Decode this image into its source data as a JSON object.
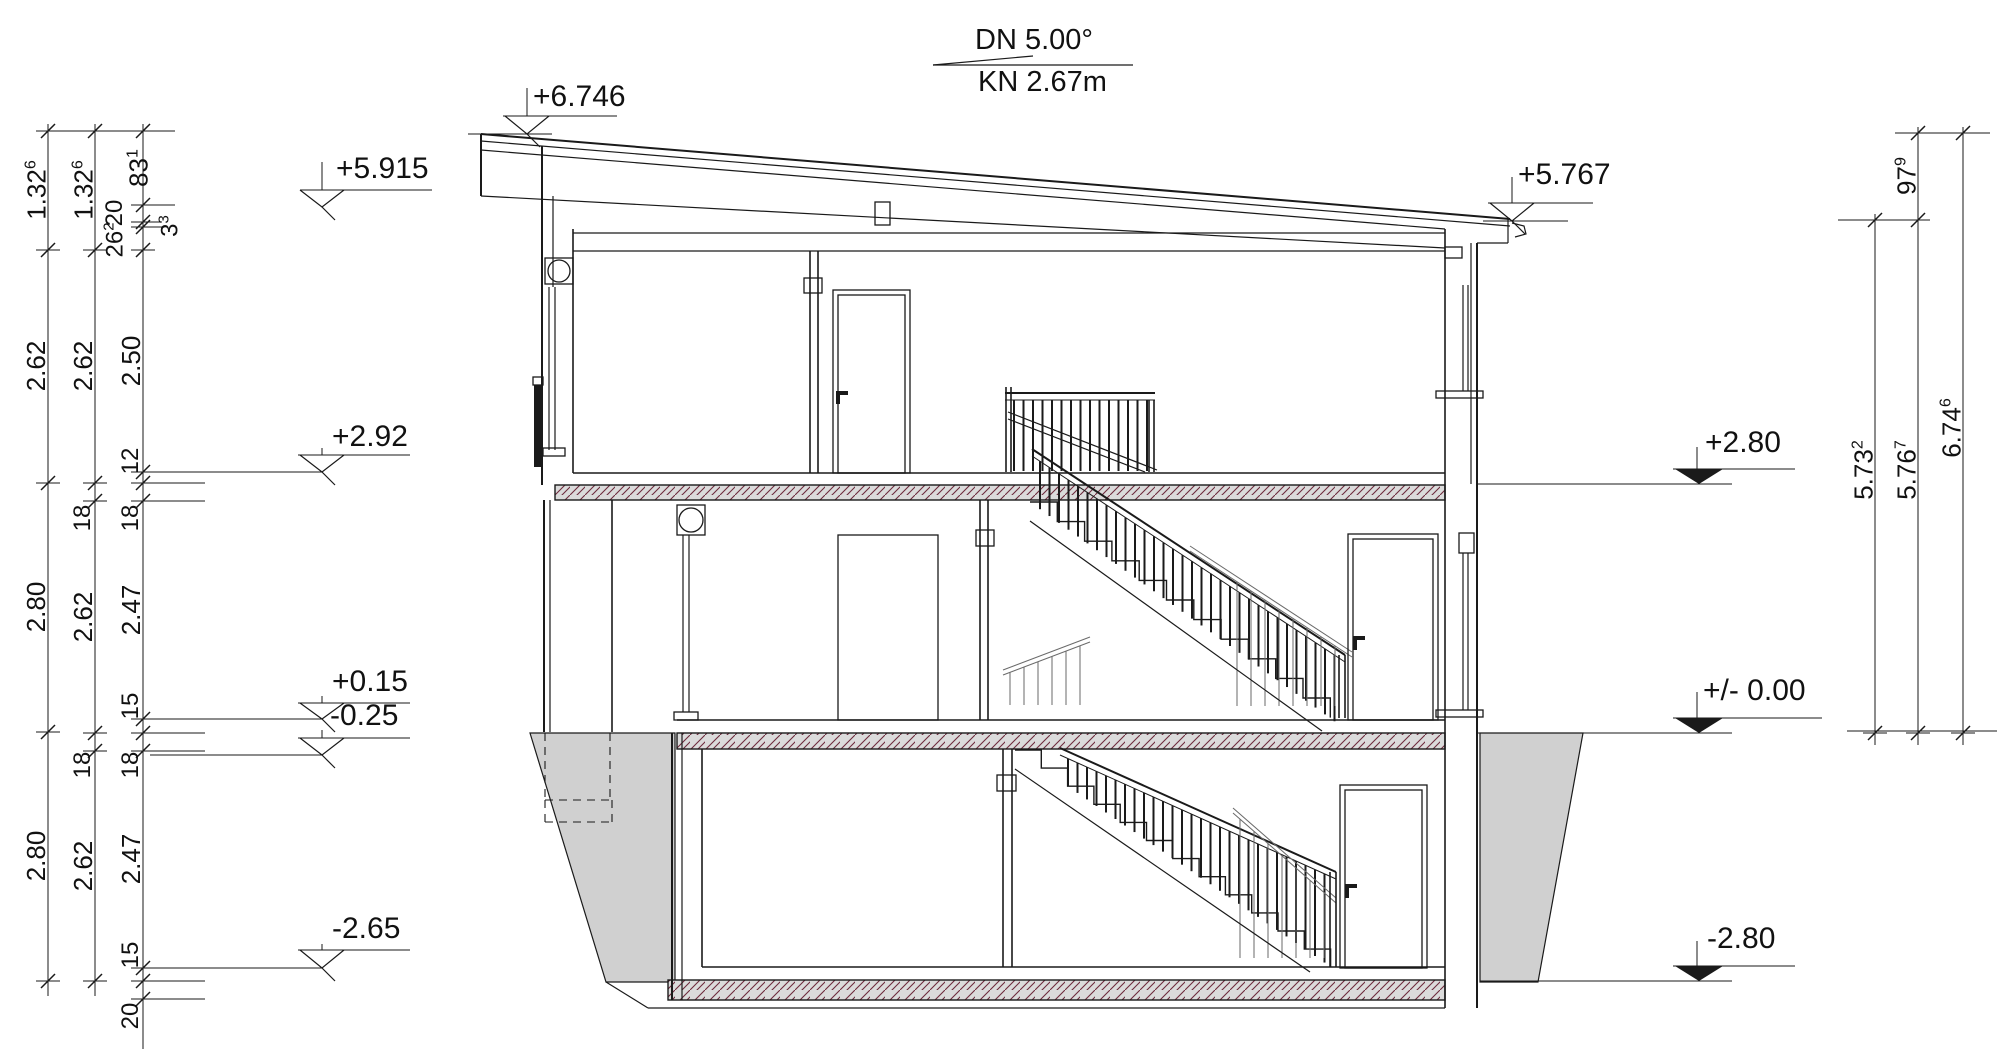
{
  "meta": {
    "drawing_type": "building-section-elevation"
  },
  "roof": {
    "slope_label": "DN 5.00°",
    "eave_label": "KN 2.67m"
  },
  "colors": {
    "line": "#1a1a1a",
    "light_line": "#6a6a6a",
    "text": "#111111",
    "slab_fill": "#dbdbdb",
    "slab_hatch": "#6e2b3e",
    "ground_fill": "#d0d0d0"
  },
  "levels": [
    {
      "id": "peak",
      "label": "+6.746",
      "tx": 533,
      "ty": 82,
      "tip": [
        527,
        134
      ],
      "wy": 116,
      "style": "open"
    },
    {
      "id": "eave-left",
      "label": "+5.915",
      "tx": 336,
      "ty": 154,
      "tip": [
        322,
        207
      ],
      "wy": 190,
      "style": "open"
    },
    {
      "id": "ff-og",
      "label": "+2.92",
      "tx": 332,
      "ty": 422,
      "tip": [
        322,
        472
      ],
      "wy": 455,
      "style": "open"
    },
    {
      "id": "ff-eg",
      "label": "+0.15",
      "tx": 332,
      "ty": 667,
      "tip": [
        322,
        719
      ],
      "wy": 703,
      "style": "open"
    },
    {
      "id": "uk-eg",
      "label": "-0.25",
      "tx": 330,
      "ty": 701,
      "tip": [
        322,
        755
      ],
      "wy": 738,
      "style": "open"
    },
    {
      "id": "ff-kg",
      "label": "-2.65",
      "tx": 332,
      "ty": 914,
      "tip": [
        322,
        968
      ],
      "wy": 950,
      "style": "open"
    },
    {
      "id": "eave-right",
      "label": "+5.767",
      "tx": 1518,
      "ty": 160,
      "tip": [
        1512,
        221
      ],
      "wy": 203,
      "style": "open"
    },
    {
      "id": "slab-og",
      "label": "+2.80",
      "tx": 1705,
      "ty": 428,
      "tip": [
        1699,
        484
      ],
      "wy": 469,
      "style": "filled"
    },
    {
      "id": "zero",
      "label": "+/- 0.00",
      "tx": 1703,
      "ty": 676,
      "tip": [
        1699,
        733
      ],
      "wy": 718,
      "style": "filled"
    },
    {
      "id": "slab-kg",
      "label": "-2.80",
      "tx": 1707,
      "ty": 924,
      "tip": [
        1699,
        981
      ],
      "wy": 966,
      "style": "filled"
    }
  ],
  "chains_left": [
    {
      "x": 48,
      "y1": 124,
      "y2": 996,
      "ticks": [
        131,
        250,
        483,
        732,
        981
      ],
      "labels": [
        {
          "t": "1.32",
          "s": "6",
          "y": 190
        },
        {
          "t": "2.62",
          "y": 366
        },
        {
          "t": "2.80",
          "y": 607
        },
        {
          "t": "2.80",
          "y": 856
        }
      ]
    },
    {
      "x": 95,
      "y1": 124,
      "y2": 996,
      "ticks": [
        131,
        250,
        483,
        501,
        733,
        751,
        981
      ],
      "labels": [
        {
          "t": "1.32",
          "s": "6",
          "y": 190
        },
        {
          "t": "2.62",
          "y": 366
        },
        {
          "t": "18",
          "y": 518,
          "sm": 1
        },
        {
          "t": "2.62",
          "y": 617
        },
        {
          "t": "18",
          "y": 765,
          "sm": 1
        },
        {
          "t": "2.62",
          "y": 866
        }
      ]
    },
    {
      "x": 143,
      "y1": 124,
      "y2": 1049,
      "ticks": [
        131,
        205,
        222,
        227,
        250,
        472,
        483,
        501,
        719,
        733,
        751,
        968,
        981,
        999
      ],
      "labels": [
        {
          "t": "83",
          "s": "1",
          "y": 168,
          "dx": -5
        },
        {
          "t": "20",
          "y": 213,
          "dx": -28,
          "sm": 1
        },
        {
          "t": "26",
          "s": "2",
          "y": 240,
          "dx": -28,
          "sm": 1
        },
        {
          "t": "3",
          "s": "3",
          "y": 226,
          "dx": 27,
          "sm": 1
        },
        {
          "t": "2.50",
          "y": 361
        },
        {
          "t": "12",
          "y": 461,
          "sm": 1
        },
        {
          "t": "18",
          "y": 518,
          "sm": 1
        },
        {
          "t": "2.47",
          "y": 610
        },
        {
          "t": "15",
          "y": 706,
          "sm": 1
        },
        {
          "t": "18",
          "y": 765,
          "sm": 1
        },
        {
          "t": "2.47",
          "y": 859
        },
        {
          "t": "15",
          "y": 955,
          "sm": 1
        },
        {
          "t": "20",
          "y": 1016,
          "sm": 1
        }
      ]
    }
  ],
  "chains_right": [
    {
      "x": 1875,
      "y1": 214,
      "y2": 745,
      "ticks": [
        220,
        733
      ],
      "labels": [
        {
          "t": "5.73",
          "s": "2",
          "y": 470
        }
      ]
    },
    {
      "x": 1918,
      "y1": 127,
      "y2": 745,
      "ticks": [
        133,
        220,
        733
      ],
      "labels": [
        {
          "t": "97",
          "s": "9",
          "y": 176
        },
        {
          "t": "5.76",
          "s": "7",
          "y": 470
        }
      ]
    },
    {
      "x": 1963,
      "y1": 127,
      "y2": 745,
      "ticks": [
        133,
        733
      ],
      "labels": [
        {
          "t": "6.74",
          "s": "6",
          "y": 428
        }
      ]
    }
  ],
  "structure": {
    "lines": [
      [
        481,
        134,
        1510,
        219,
        2
      ],
      [
        481,
        141,
        1510,
        226,
        1.2
      ],
      [
        481,
        150,
        1445,
        229,
        1.2
      ],
      [
        481,
        196,
        1445,
        248,
        1.2
      ],
      [
        481,
        134,
        481,
        196,
        2
      ],
      [
        1508,
        219,
        1508,
        243,
        1.2
      ],
      [
        1477,
        243,
        1508,
        243,
        1.2
      ],
      [
        573,
        233,
        1445,
        233,
        1.2
      ],
      [
        573,
        251,
        1445,
        251,
        1.2
      ],
      [
        573,
        473,
        1445,
        473,
        1.6
      ],
      [
        677,
        720,
        1445,
        720,
        1.6
      ],
      [
        702,
        967,
        1445,
        967,
        1.6
      ],
      [
        648,
        1008,
        1445,
        1008,
        1.2
      ],
      [
        606,
        982,
        648,
        1008,
        1.2
      ],
      [
        542,
        146,
        542,
        485,
        2
      ],
      [
        553,
        196,
        553,
        287,
        1.2
      ],
      [
        573,
        229,
        573,
        473,
        1.6
      ],
      [
        549,
        287,
        549,
        450,
        1.2
      ],
      [
        555,
        287,
        555,
        450,
        1.2
      ],
      [
        544,
        500,
        544,
        732,
        2
      ],
      [
        550,
        500,
        550,
        732,
        1.2
      ],
      [
        612,
        500,
        612,
        732,
        1.6
      ],
      [
        683,
        535,
        683,
        712,
        1.2
      ],
      [
        689,
        535,
        689,
        712,
        1.2
      ],
      [
        672,
        733,
        672,
        1000,
        2
      ],
      [
        682,
        733,
        682,
        1000,
        1.2
      ],
      [
        702,
        749,
        702,
        967,
        1.6
      ],
      [
        1445,
        229,
        1445,
        1008,
        1.6
      ],
      [
        1471,
        243,
        1471,
        484,
        1.2
      ],
      [
        1477,
        243,
        1477,
        1008,
        2
      ],
      [
        1463,
        285,
        1463,
        391,
        1.2
      ],
      [
        1468,
        285,
        1468,
        391,
        1.2
      ],
      [
        1463,
        553,
        1463,
        710,
        1.2
      ],
      [
        1468,
        553,
        1468,
        710,
        1.2
      ],
      [
        810,
        251,
        810,
        473,
        1.6
      ],
      [
        818,
        251,
        818,
        473,
        1.6
      ],
      [
        980,
        500,
        980,
        720,
        1.6
      ],
      [
        988,
        500,
        988,
        720,
        1.6
      ],
      [
        1003,
        749,
        1003,
        967,
        1.6
      ],
      [
        1012,
        749,
        1012,
        967,
        1.6
      ],
      [
        1008,
        412,
        1157,
        470,
        1.2
      ],
      [
        1008,
        419,
        1145,
        472,
        1.2
      ],
      [
        1030,
        521,
        1322,
        731,
        1.2
      ],
      [
        1015,
        769,
        1310,
        972,
        1.2
      ],
      [
        1006,
        387,
        1006,
        472,
        1.6
      ],
      [
        1011,
        387,
        1011,
        472,
        1.6
      ],
      [
        1149,
        400,
        1149,
        472,
        1.6
      ],
      [
        1154,
        400,
        1154,
        472,
        1.6
      ],
      [
        1339,
        655,
        1339,
        718,
        1.6
      ],
      [
        1345,
        655,
        1345,
        718,
        1.6
      ],
      [
        1330,
        872,
        1330,
        967,
        1.6
      ],
      [
        1336,
        872,
        1336,
        967,
        1.6
      ],
      [
        40,
        131,
        175,
        131,
        1
      ],
      [
        143,
        205,
        175,
        205,
        1
      ],
      [
        146,
        222,
        162,
        222,
        1
      ],
      [
        146,
        227,
        162,
        227,
        1
      ],
      [
        143,
        483,
        205,
        483,
        1
      ],
      [
        143,
        501,
        205,
        501,
        1
      ],
      [
        143,
        733,
        205,
        733,
        1
      ],
      [
        143,
        751,
        205,
        751,
        1
      ],
      [
        143,
        981,
        205,
        981,
        1
      ],
      [
        143,
        999,
        205,
        999,
        1
      ],
      [
        143,
        472,
        322,
        472,
        1
      ],
      [
        143,
        719,
        322,
        719,
        1
      ],
      [
        150,
        755,
        322,
        755,
        1
      ],
      [
        143,
        968,
        322,
        968,
        1
      ],
      [
        503,
        116,
        617,
        116,
        1
      ],
      [
        527,
        88,
        527,
        116,
        1
      ],
      [
        468,
        134,
        552,
        134,
        1
      ],
      [
        300,
        190,
        432,
        190,
        1
      ],
      [
        322,
        162,
        322,
        190,
        1
      ],
      [
        298,
        455,
        410,
        455,
        1
      ],
      [
        322,
        448,
        322,
        455,
        1
      ],
      [
        298,
        703,
        410,
        703,
        1
      ],
      [
        322,
        696,
        322,
        703,
        1
      ],
      [
        298,
        738,
        410,
        738,
        1
      ],
      [
        322,
        730,
        322,
        738,
        1
      ],
      [
        298,
        950,
        410,
        950,
        1
      ],
      [
        322,
        944,
        322,
        950,
        1
      ],
      [
        1488,
        203,
        1593,
        203,
        1
      ],
      [
        1512,
        177,
        1512,
        203,
        1
      ],
      [
        1483,
        221,
        1568,
        221,
        1
      ],
      [
        1673,
        469,
        1795,
        469,
        1
      ],
      [
        1697,
        447,
        1697,
        469,
        1
      ],
      [
        1477,
        484,
        1732,
        484,
        1
      ],
      [
        1673,
        718,
        1822,
        718,
        1
      ],
      [
        1697,
        692,
        1697,
        718,
        1
      ],
      [
        1477,
        733,
        1732,
        733,
        1
      ],
      [
        1673,
        966,
        1795,
        966,
        1
      ],
      [
        1697,
        941,
        1697,
        966,
        1
      ],
      [
        1480,
        981,
        1732,
        981,
        1
      ],
      [
        1895,
        133,
        1990,
        133,
        1
      ],
      [
        1838,
        220,
        1928,
        220,
        1
      ],
      [
        1847,
        731,
        1997,
        731,
        1
      ],
      [
        933,
        65,
        1133,
        65,
        1.2
      ],
      [
        933,
        65,
        1033,
        56,
        1.2
      ]
    ],
    "dashed_lines": [
      [
        545,
        733,
        545,
        800
      ],
      [
        610,
        733,
        610,
        800
      ],
      [
        545,
        800,
        612,
        800
      ],
      [
        545,
        822,
        612,
        822
      ],
      [
        545,
        800,
        545,
        822
      ],
      [
        612,
        800,
        612,
        822
      ]
    ],
    "rects": [
      [
        875,
        202,
        15,
        23
      ],
      [
        545,
        258,
        28,
        26
      ],
      [
        1445,
        247,
        17,
        11
      ],
      [
        804,
        278,
        18,
        15
      ],
      [
        976,
        530,
        18,
        16
      ],
      [
        997,
        775,
        19,
        16
      ],
      [
        677,
        505,
        28,
        30
      ],
      [
        543,
        448,
        22,
        8
      ],
      [
        674,
        712,
        24,
        8
      ],
      [
        1436,
        391,
        47,
        7
      ],
      [
        1459,
        533,
        15,
        20
      ],
      [
        1436,
        710,
        47,
        7
      ],
      [
        533,
        377,
        10,
        8
      ],
      [
        833,
        290,
        77,
        183
      ],
      [
        838,
        295,
        67,
        178
      ],
      [
        838,
        535,
        100,
        185
      ],
      [
        1348,
        534,
        90,
        186
      ],
      [
        1353,
        539,
        80,
        181
      ],
      [
        1340,
        785,
        87,
        183
      ],
      [
        1345,
        790,
        77,
        178
      ]
    ],
    "filled_rects": [
      [
        836,
        391,
        12,
        4
      ],
      [
        836,
        391,
        4,
        13
      ],
      [
        1353,
        636,
        12,
        4
      ],
      [
        1353,
        636,
        4,
        14
      ],
      [
        1345,
        884,
        12,
        4
      ],
      [
        1345,
        884,
        4,
        14
      ],
      [
        534,
        385,
        9,
        82
      ]
    ],
    "circles": [
      [
        559,
        271,
        11
      ],
      [
        691,
        520,
        12
      ]
    ],
    "hatched_rects": [
      [
        555,
        485,
        890,
        15
      ],
      [
        677,
        733,
        768,
        16
      ],
      [
        668,
        980,
        777,
        20
      ]
    ],
    "ground_polys": [
      [
        [
          530,
          733
        ],
        [
          675,
          733
        ],
        [
          675,
          982
        ],
        [
          606,
          982
        ]
      ],
      [
        [
          1480,
          733
        ],
        [
          1583,
          733
        ],
        [
          1538,
          982
        ],
        [
          1480,
          982
        ]
      ]
    ],
    "paths": [
      "M1512,223 L1524,226 L1526,234 L1515,237"
    ],
    "stairs": [
      {
        "x0": 1030,
        "y0": 502,
        "n": 11,
        "dx": 27.3,
        "dy": 19.6
      },
      {
        "x0": 1015,
        "y0": 750,
        "n": 12,
        "dx": 26.3,
        "dy": 18.1
      }
    ],
    "railings": [
      {
        "rail": [
          1005,
          393,
          1155,
          393
        ],
        "off": 7,
        "bx1": 1014,
        "bx2": 1148,
        "step": 9.5,
        "bottom": {
          "y": 471
        },
        "w": 2,
        "light": 0
      },
      {
        "rail": [
          1032,
          449,
          1345,
          655
        ],
        "off": 7,
        "bx1": 1040,
        "bx2": 1338,
        "step": 9.5,
        "bottom": {
          "line": [
            1030,
            502,
            1330,
            718
          ]
        },
        "w": 2,
        "light": 0
      },
      {
        "rail": [
          1190,
          546,
          1352,
          652
        ],
        "off": 5,
        "bx1": 1237,
        "bx2": 1345,
        "step": 14,
        "bottom": {
          "y": 706
        },
        "w": 1,
        "light": 1
      },
      {
        "rail": [
          1003,
          670,
          1090,
          637
        ],
        "off": 5,
        "bx1": 1010,
        "bx2": 1085,
        "step": 14,
        "bottom": {
          "y": 705
        },
        "w": 1,
        "light": 1
      },
      {
        "rail": [
          1060,
          748,
          1336,
          872
        ],
        "off": 7,
        "bx1": 1068,
        "bx2": 1330,
        "step": 9.5,
        "bottom": {
          "line": [
            1015,
            750,
            1331,
            967
          ]
        },
        "w": 2,
        "light": 0
      },
      {
        "rail": [
          1233,
          808,
          1336,
          898
        ],
        "off": 5,
        "bx1": 1240,
        "bx2": 1330,
        "step": 14,
        "bottom": {
          "y": 958
        },
        "w": 1,
        "light": 1
      }
    ]
  }
}
